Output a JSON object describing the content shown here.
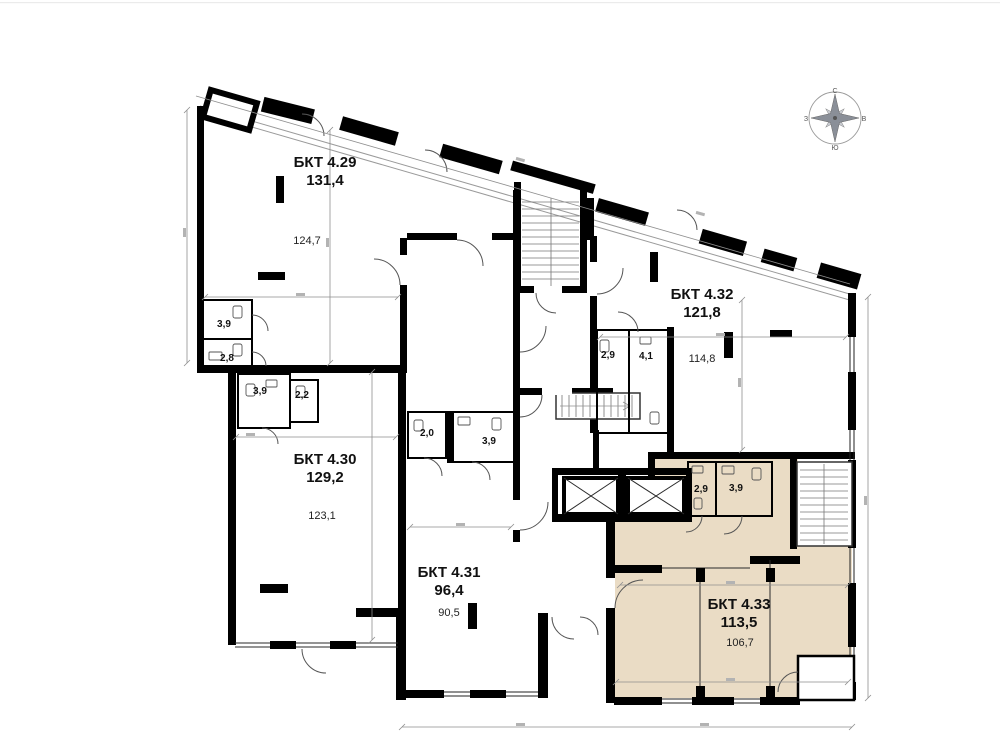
{
  "canvas": {
    "background": "#ffffff"
  },
  "colors": {
    "wall": "#000000",
    "highlight_fill": "#eadcc5",
    "dimension_line": "#8f8f8f"
  },
  "compass": {
    "north": "С",
    "south": "Ю",
    "west": "З",
    "east": "В"
  },
  "units": [
    {
      "id": "4.29",
      "name": "БКТ 4.29",
      "total_area": "131,4",
      "main_room_area": "124,7",
      "wet_rooms": [
        {
          "area": "3,9"
        },
        {
          "area": "2,8"
        }
      ],
      "highlighted": false
    },
    {
      "id": "4.30",
      "name": "БКТ 4.30",
      "total_area": "129,2",
      "main_room_area": "123,1",
      "wet_rooms": [
        {
          "area": "3,9"
        },
        {
          "area": "2,2"
        }
      ],
      "highlighted": false
    },
    {
      "id": "4.31",
      "name": "БКТ 4.31",
      "total_area": "96,4",
      "main_room_area": "90,5",
      "wet_rooms": [
        {
          "area": "2,0"
        },
        {
          "area": "3,9"
        }
      ],
      "highlighted": false
    },
    {
      "id": "4.32",
      "name": "БКТ 4.32",
      "total_area": "121,8",
      "main_room_area": "114,8",
      "wet_rooms": [
        {
          "area": "2,9"
        },
        {
          "area": "4,1"
        }
      ],
      "highlighted": false
    },
    {
      "id": "4.33",
      "name": "БКТ 4.33",
      "total_area": "113,5",
      "main_room_area": "106,7",
      "wet_rooms": [
        {
          "area": "2,9"
        },
        {
          "area": "3,9"
        }
      ],
      "highlighted": true
    }
  ]
}
